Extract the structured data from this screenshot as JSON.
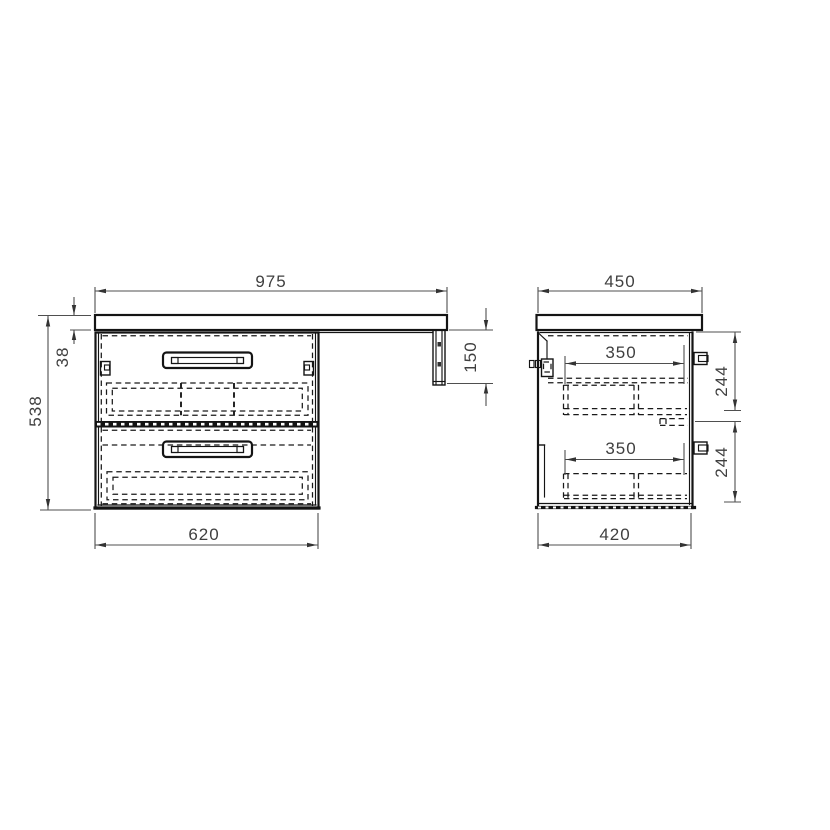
{
  "drawing": {
    "type": "furniture-technical-drawing",
    "views": {
      "front": {
        "dimensions": {
          "total_width": "975",
          "countertop_thickness": "38",
          "total_height": "538",
          "side_bracket_height": "150",
          "cabinet_width": "620"
        }
      },
      "side": {
        "dimensions": {
          "total_depth": "450",
          "top_drawer_inner_depth": "350",
          "bottom_drawer_inner_depth": "350",
          "top_drawer_inner_height": "244",
          "bottom_drawer_inner_height": "244",
          "cabinet_depth": "420"
        }
      }
    },
    "colors": {
      "background": "#ffffff",
      "object_line": "#141414",
      "dimension_line": "#4f4f4f",
      "dimension_text": "#3f3f3f"
    }
  }
}
